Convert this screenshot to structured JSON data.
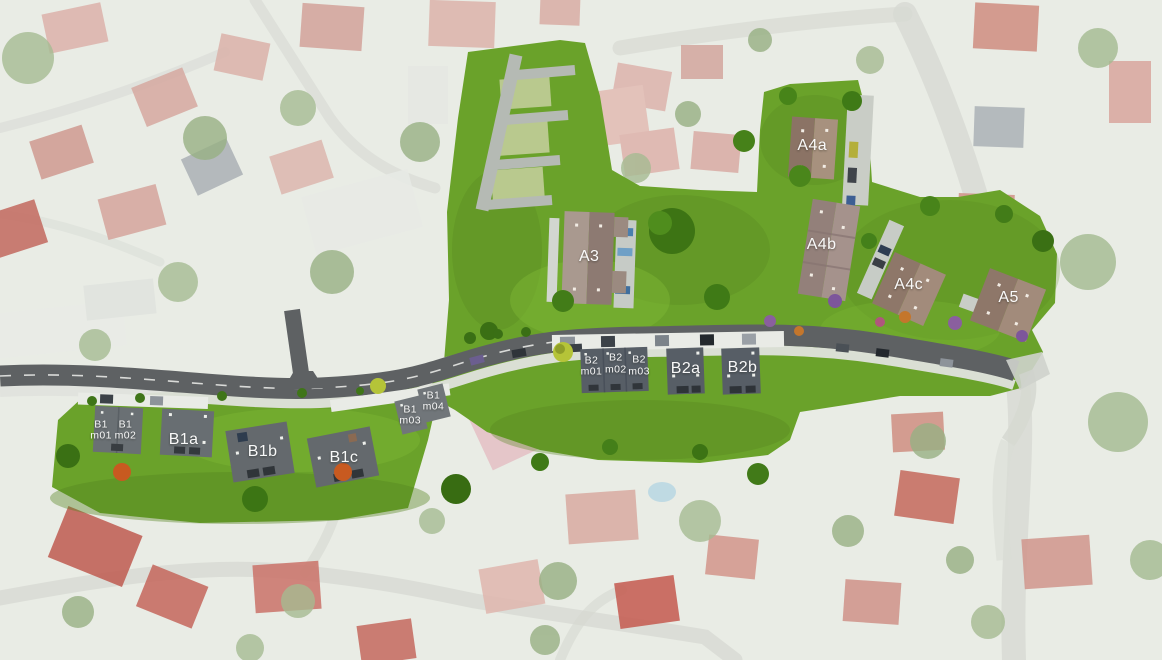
{
  "site": {
    "plan_kind_colors": {
      "development_lawn_green": "#6aa22a",
      "lawn_shadow_green": "#4e7d1c",
      "road_asphalt": "#5e6163",
      "sidewalk_light": "#e0e3dd",
      "new_roof_a_light": "#a7917e",
      "new_roof_a_dark": "#8b7365",
      "new_roof_b_gray": "#575e66",
      "faded_house_roof": "#d6a8a0",
      "label_text": "#ffffff"
    }
  },
  "buildings": [
    {
      "id": "A4a",
      "label": "A4a",
      "sub": "",
      "x_pct": 69.9,
      "y_pct": 22.1,
      "size": "large",
      "group": "A"
    },
    {
      "id": "A4b",
      "label": "A4b",
      "sub": "",
      "x_pct": 70.7,
      "y_pct": 37.1,
      "size": "large",
      "group": "A"
    },
    {
      "id": "A4c",
      "label": "A4c",
      "sub": "",
      "x_pct": 78.2,
      "y_pct": 43.2,
      "size": "large",
      "group": "A"
    },
    {
      "id": "A5",
      "label": "A5",
      "sub": "",
      "x_pct": 86.8,
      "y_pct": 45.2,
      "size": "large",
      "group": "A"
    },
    {
      "id": "A3",
      "label": "A3",
      "sub": "",
      "x_pct": 50.7,
      "y_pct": 38.9,
      "size": "large",
      "group": "A"
    },
    {
      "id": "B2-m01",
      "label": "B2",
      "sub": "m01",
      "x_pct": 50.9,
      "y_pct": 55.6,
      "size": "small",
      "group": "B"
    },
    {
      "id": "B2-m02",
      "label": "B2",
      "sub": "m02",
      "x_pct": 53.0,
      "y_pct": 55.2,
      "size": "small",
      "group": "B"
    },
    {
      "id": "B2-m03",
      "label": "B2",
      "sub": "m03",
      "x_pct": 55.0,
      "y_pct": 55.5,
      "size": "small",
      "group": "B"
    },
    {
      "id": "B2a",
      "label": "B2a",
      "sub": "",
      "x_pct": 59.0,
      "y_pct": 55.9,
      "size": "large",
      "group": "B"
    },
    {
      "id": "B2b",
      "label": "B2b",
      "sub": "",
      "x_pct": 63.9,
      "y_pct": 55.8,
      "size": "large",
      "group": "B"
    },
    {
      "id": "B1-m01",
      "label": "B1",
      "sub": "m01",
      "x_pct": 8.7,
      "y_pct": 65.3,
      "size": "small",
      "group": "B"
    },
    {
      "id": "B1-m02",
      "label": "B1",
      "sub": "m02",
      "x_pct": 10.8,
      "y_pct": 65.3,
      "size": "small",
      "group": "B"
    },
    {
      "id": "B1a",
      "label": "B1a",
      "sub": "",
      "x_pct": 15.8,
      "y_pct": 66.7,
      "size": "large",
      "group": "B"
    },
    {
      "id": "B1b",
      "label": "B1b",
      "sub": "",
      "x_pct": 22.6,
      "y_pct": 68.5,
      "size": "large",
      "group": "B"
    },
    {
      "id": "B1c",
      "label": "B1c",
      "sub": "",
      "x_pct": 29.6,
      "y_pct": 69.4,
      "size": "large",
      "group": "B"
    },
    {
      "id": "B1-m03",
      "label": "B1",
      "sub": "m03",
      "x_pct": 35.3,
      "y_pct": 63.0,
      "size": "small",
      "group": "B"
    },
    {
      "id": "B1-m04",
      "label": "B1",
      "sub": "m04",
      "x_pct": 37.3,
      "y_pct": 60.9,
      "size": "small",
      "group": "B"
    }
  ]
}
